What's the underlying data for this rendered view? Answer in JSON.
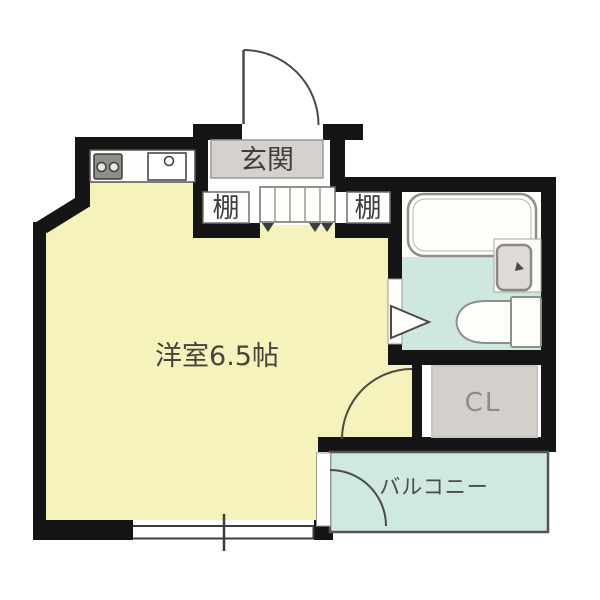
{
  "plan": {
    "kind": "japanese-apartment-floor-plan",
    "background": "#ffffff"
  },
  "labels": {
    "entrance": "玄関",
    "shelf_left": "棚",
    "shelf_right": "棚",
    "main_room": "洋室6.5帖",
    "closet": "CL",
    "balcony": "バルコニー"
  },
  "rooms": [
    {
      "name": "entrance",
      "label": "玄関"
    },
    {
      "name": "main-room",
      "label": "洋室6.5帖",
      "size": "6.5帖"
    },
    {
      "name": "closet",
      "label": "CL"
    },
    {
      "name": "balcony",
      "label": "バルコニー"
    },
    {
      "name": "bathroom",
      "label": ""
    }
  ],
  "fixtures": {
    "bathtub": "bathtub",
    "toilet": "toilet",
    "washbasin": "wash-basin",
    "stove": "two-burner-stove",
    "kitchen_sink": "kitchen-sink",
    "entry_door": "entry-door-swing",
    "closet_door": "closet-door-swing",
    "balcony_door": "balcony-door-swing",
    "bath_door": "bathroom-door-marker",
    "window": "bottom-window",
    "entrance_step": "entrance-step"
  },
  "colors": {
    "wall": "#151515",
    "room_floor": "#f6f2bb",
    "bath_floor": "#cee8e0",
    "balcony_floor": "#cfe8e2",
    "entrance_floor": "#d5d2cd",
    "closet_floor": "#d3d0cc",
    "white_floor": "#fefefc",
    "fixture_outline": "#8f8f89",
    "door_line": "#4a4a46",
    "label_dark": "#3e3e3c",
    "label_gray": "#8c8c88"
  }
}
